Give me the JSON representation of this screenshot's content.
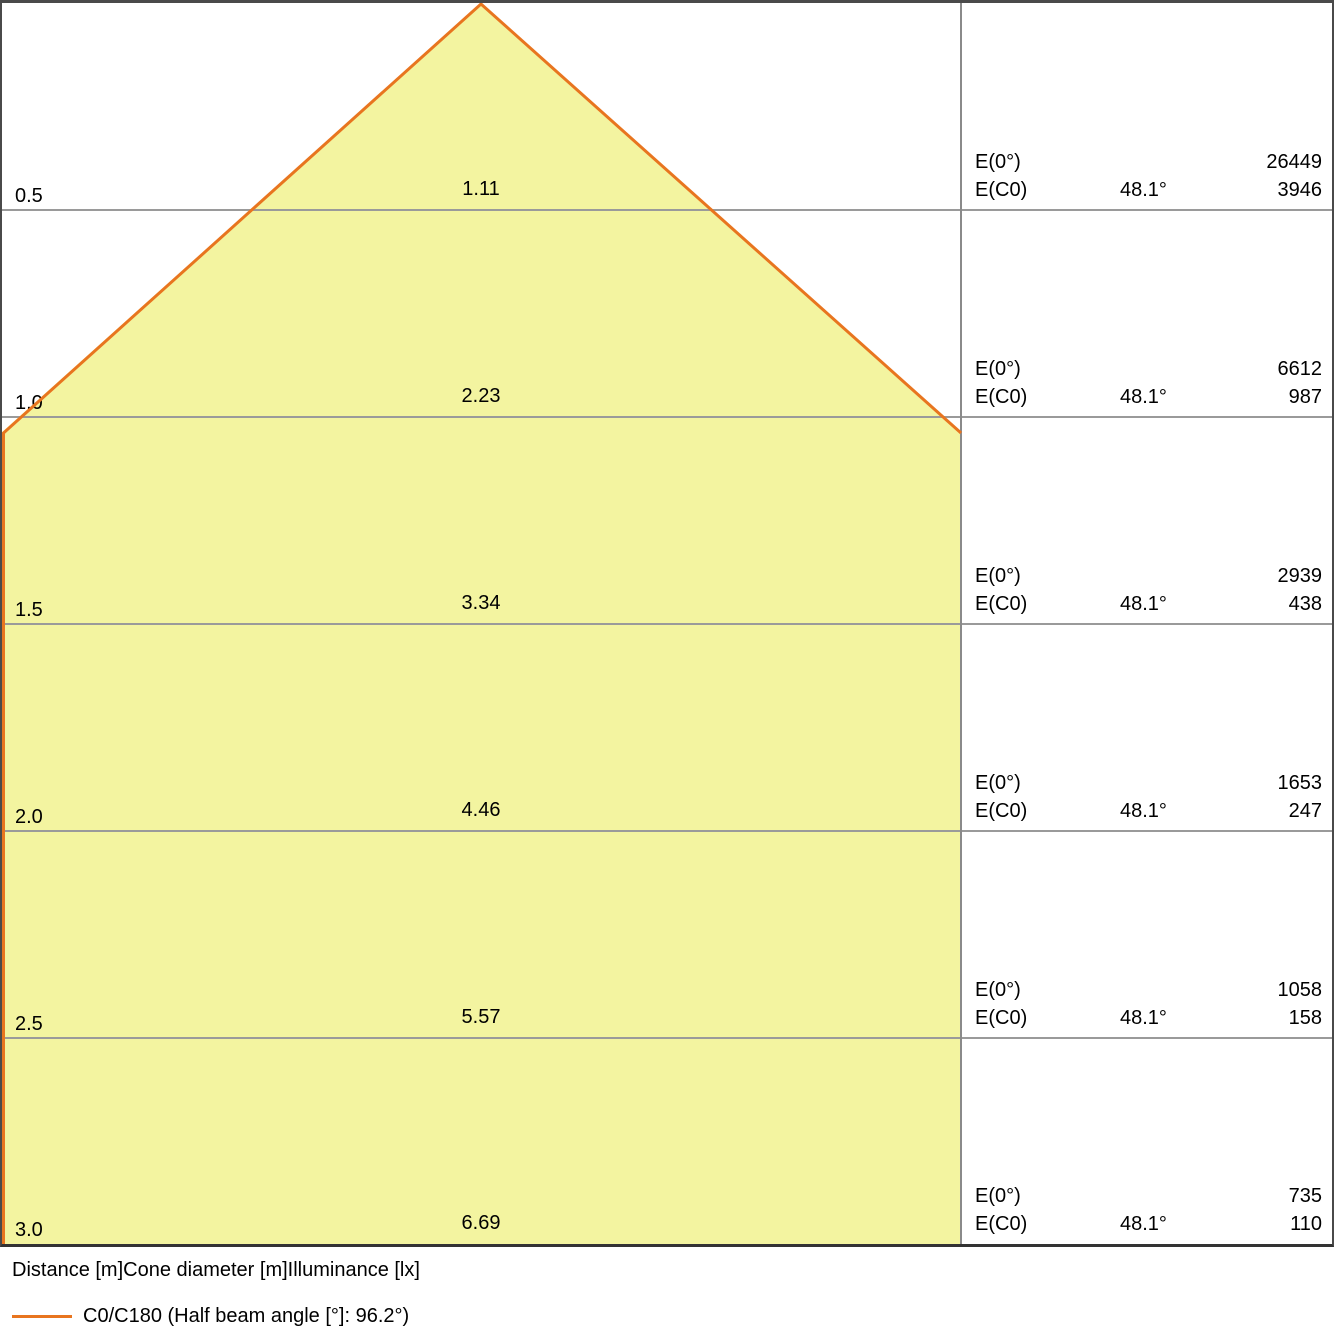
{
  "labels": {
    "e0": "E(0°)",
    "ec0": "E(C0)"
  },
  "rows": [
    {
      "distance": "0.5",
      "diameter": "1.11",
      "e0": "26449",
      "angle": "48.1°",
      "ec0": "3946"
    },
    {
      "distance": "1.0",
      "diameter": "2.23",
      "e0": "6612",
      "angle": "48.1°",
      "ec0": "987"
    },
    {
      "distance": "1.5",
      "diameter": "3.34",
      "e0": "2939",
      "angle": "48.1°",
      "ec0": "438"
    },
    {
      "distance": "2.0",
      "diameter": "4.46",
      "e0": "1653",
      "angle": "48.1°",
      "ec0": "247"
    },
    {
      "distance": "2.5",
      "diameter": "5.57",
      "e0": "1058",
      "angle": "48.1°",
      "ec0": "158"
    },
    {
      "distance": "3.0",
      "diameter": "6.69",
      "e0": "735",
      "angle": "48.1°",
      "ec0": "110"
    }
  ],
  "footer": {
    "axis_caption": "Distance [m]Cone diameter [m]Illuminance [lx]",
    "legend": "C0/C180 (Half beam angle [°]: 96.2°)"
  },
  "colors": {
    "cone_fill": "#f3f4a0",
    "cone_outline": "#e8751f",
    "gridline": "#9a9a9a",
    "divider": "#8a8a8a",
    "frame_border": "#4a4a4a"
  },
  "chart_data": {
    "type": "area",
    "description": "Luminaire light cone diagram: beam diameter and illuminance versus distance",
    "categories_label": "Distance [m]",
    "distances_m": [
      0.5,
      1.0,
      1.5,
      2.0,
      2.5,
      3.0
    ],
    "series": [
      {
        "name": "Cone diameter [m]",
        "values": [
          1.11,
          2.23,
          3.34,
          4.46,
          5.57,
          6.69
        ]
      },
      {
        "name": "E(0°) Illuminance [lx]",
        "values": [
          26449,
          6612,
          2939,
          1653,
          1058,
          735
        ]
      },
      {
        "name": "E(C0) Illuminance [lx]",
        "values": [
          3946,
          987,
          438,
          247,
          158,
          110
        ]
      },
      {
        "name": "E(C0) angle [°]",
        "values": [
          48.1,
          48.1,
          48.1,
          48.1,
          48.1,
          48.1
        ]
      }
    ],
    "half_beam_angle_deg": 96.2,
    "legend": [
      "C0/C180 (Half beam angle [°]: 96.2°)"
    ],
    "legend_position": "bottom",
    "grid": true,
    "units": {
      "distance": "m",
      "cone_diameter": "m",
      "illuminance": "lx"
    }
  }
}
